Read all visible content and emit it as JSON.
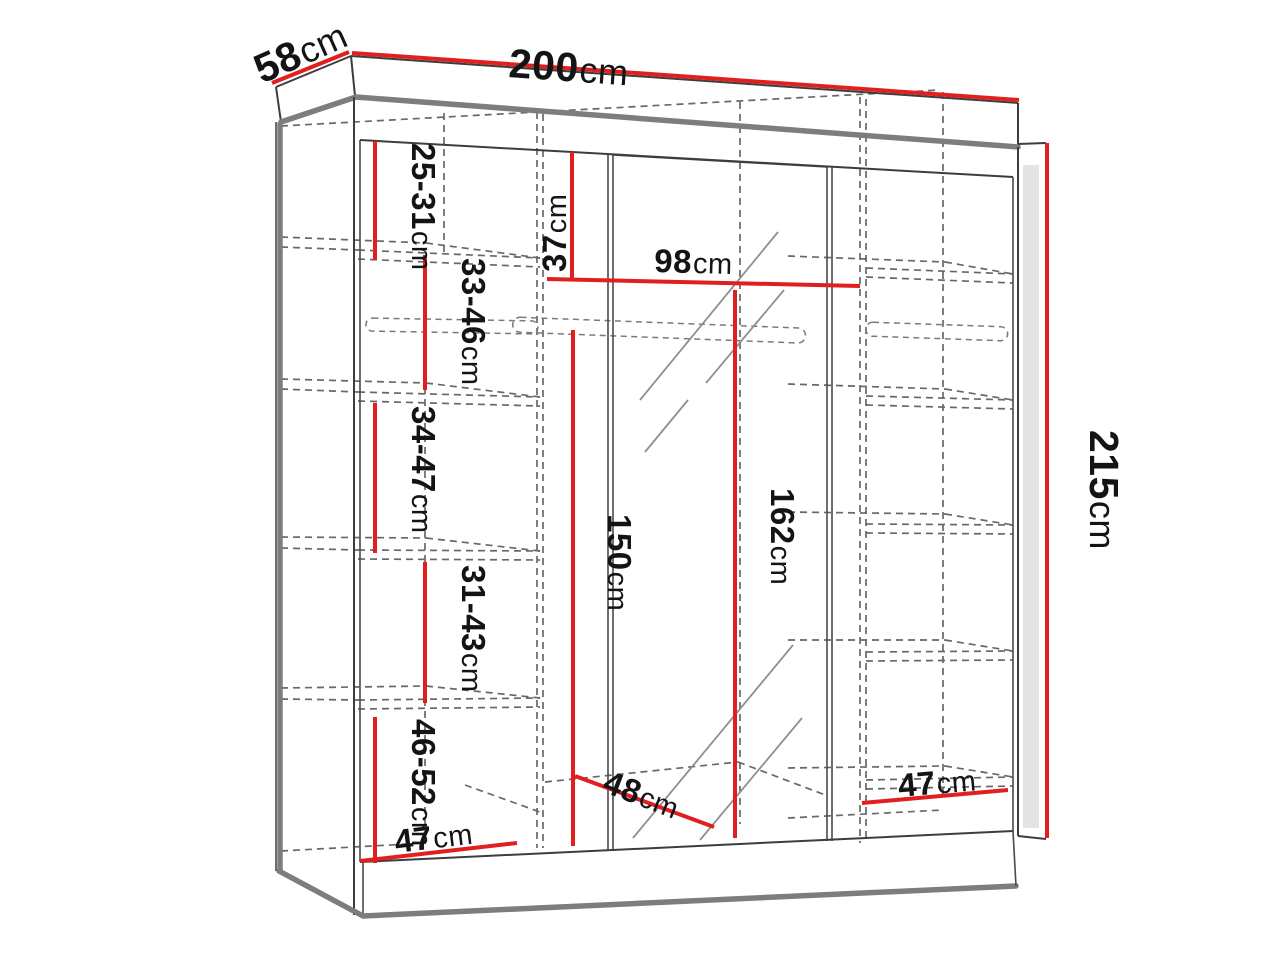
{
  "diagram": {
    "type": "furniture-dimension-diagram",
    "subject": "three-section sliding-door wardrobe with mirror",
    "unit": "cm",
    "colors": {
      "dimension_line": "#e11f1f",
      "outline": "#3d3d3d",
      "thick_edge": "#7d7d7d",
      "dashed_hidden_edge": "#686868",
      "label_text": "#141414",
      "background": "#ffffff"
    },
    "dimensions": {
      "width": {
        "value": "200",
        "unit": "cm"
      },
      "depth": {
        "value": "58",
        "unit": "cm"
      },
      "height": {
        "value": "215",
        "unit": "cm"
      },
      "top_shelf_height": {
        "value": "37",
        "unit": "cm"
      },
      "middle_section_width": {
        "value": "98",
        "unit": "cm"
      },
      "hanging_space_height": {
        "value": "150",
        "unit": "cm"
      },
      "mirror_door_height": {
        "value": "162",
        "unit": "cm"
      },
      "bottom_depth": {
        "value": "48",
        "unit": "cm"
      },
      "left_section_width": {
        "value": "47",
        "unit": "cm"
      },
      "right_section_width": {
        "value": "47",
        "unit": "cm"
      },
      "left_shelf_spacings": [
        {
          "value": "25-31",
          "unit": "cm"
        },
        {
          "value": "33-46",
          "unit": "cm"
        },
        {
          "value": "34-47",
          "unit": "cm"
        },
        {
          "value": "31-43",
          "unit": "cm"
        },
        {
          "value": "46-52",
          "unit": "cm"
        }
      ]
    }
  }
}
